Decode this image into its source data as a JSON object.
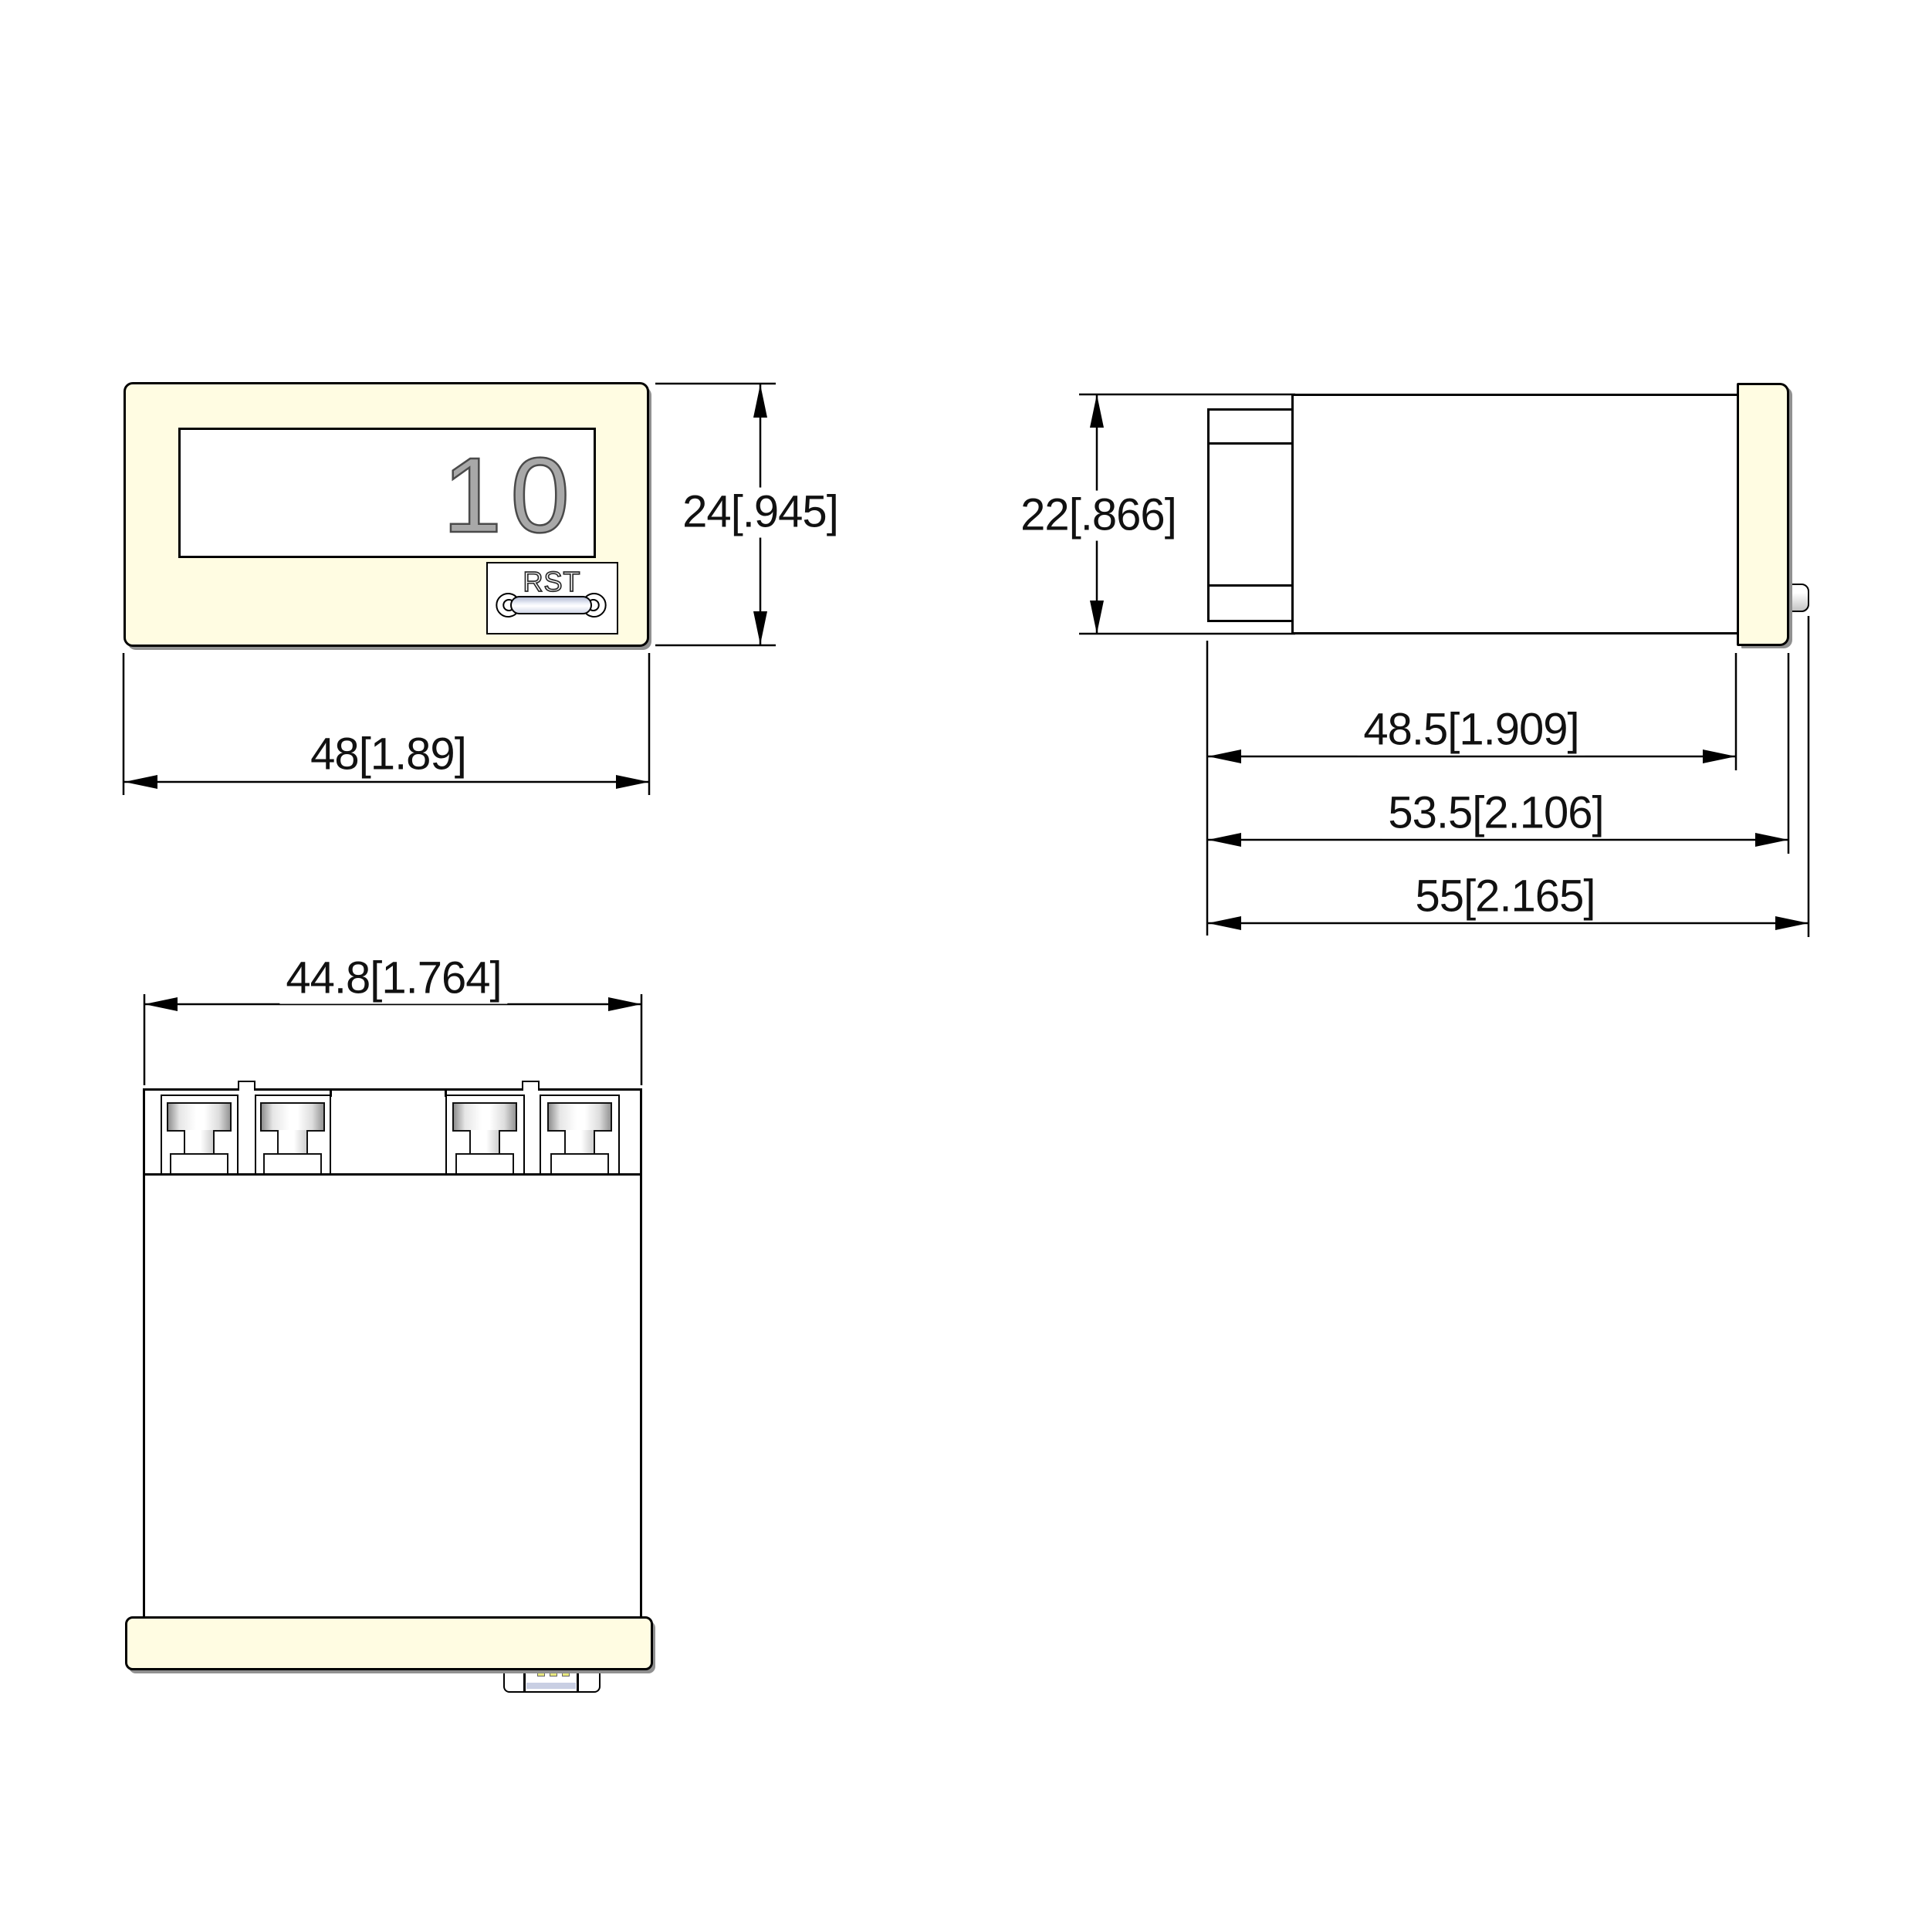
{
  "front_view": {
    "display_value": "10",
    "reset_label": "RST",
    "width_dim": "48[1.89]",
    "height_dim": "24[.945]"
  },
  "side_view": {
    "height_dim": "22[.866]",
    "panel_depth_dim": "48.5[1.909]",
    "body_depth_dim": "53.5[2.106]",
    "overall_depth_dim": "55[2.165]"
  },
  "bottom_view": {
    "width_dim": "44.8[1.764]"
  },
  "colors": {
    "housing_cream": "#FFFCE2",
    "line_black": "#000000",
    "digit_gray": "#A8A8A8",
    "digit_outline": "#4A4A4A",
    "shadow_gray": "#909090",
    "button_pill_blue": "#C9CFE3",
    "connector_pin_yellow": "#E8E87E"
  }
}
